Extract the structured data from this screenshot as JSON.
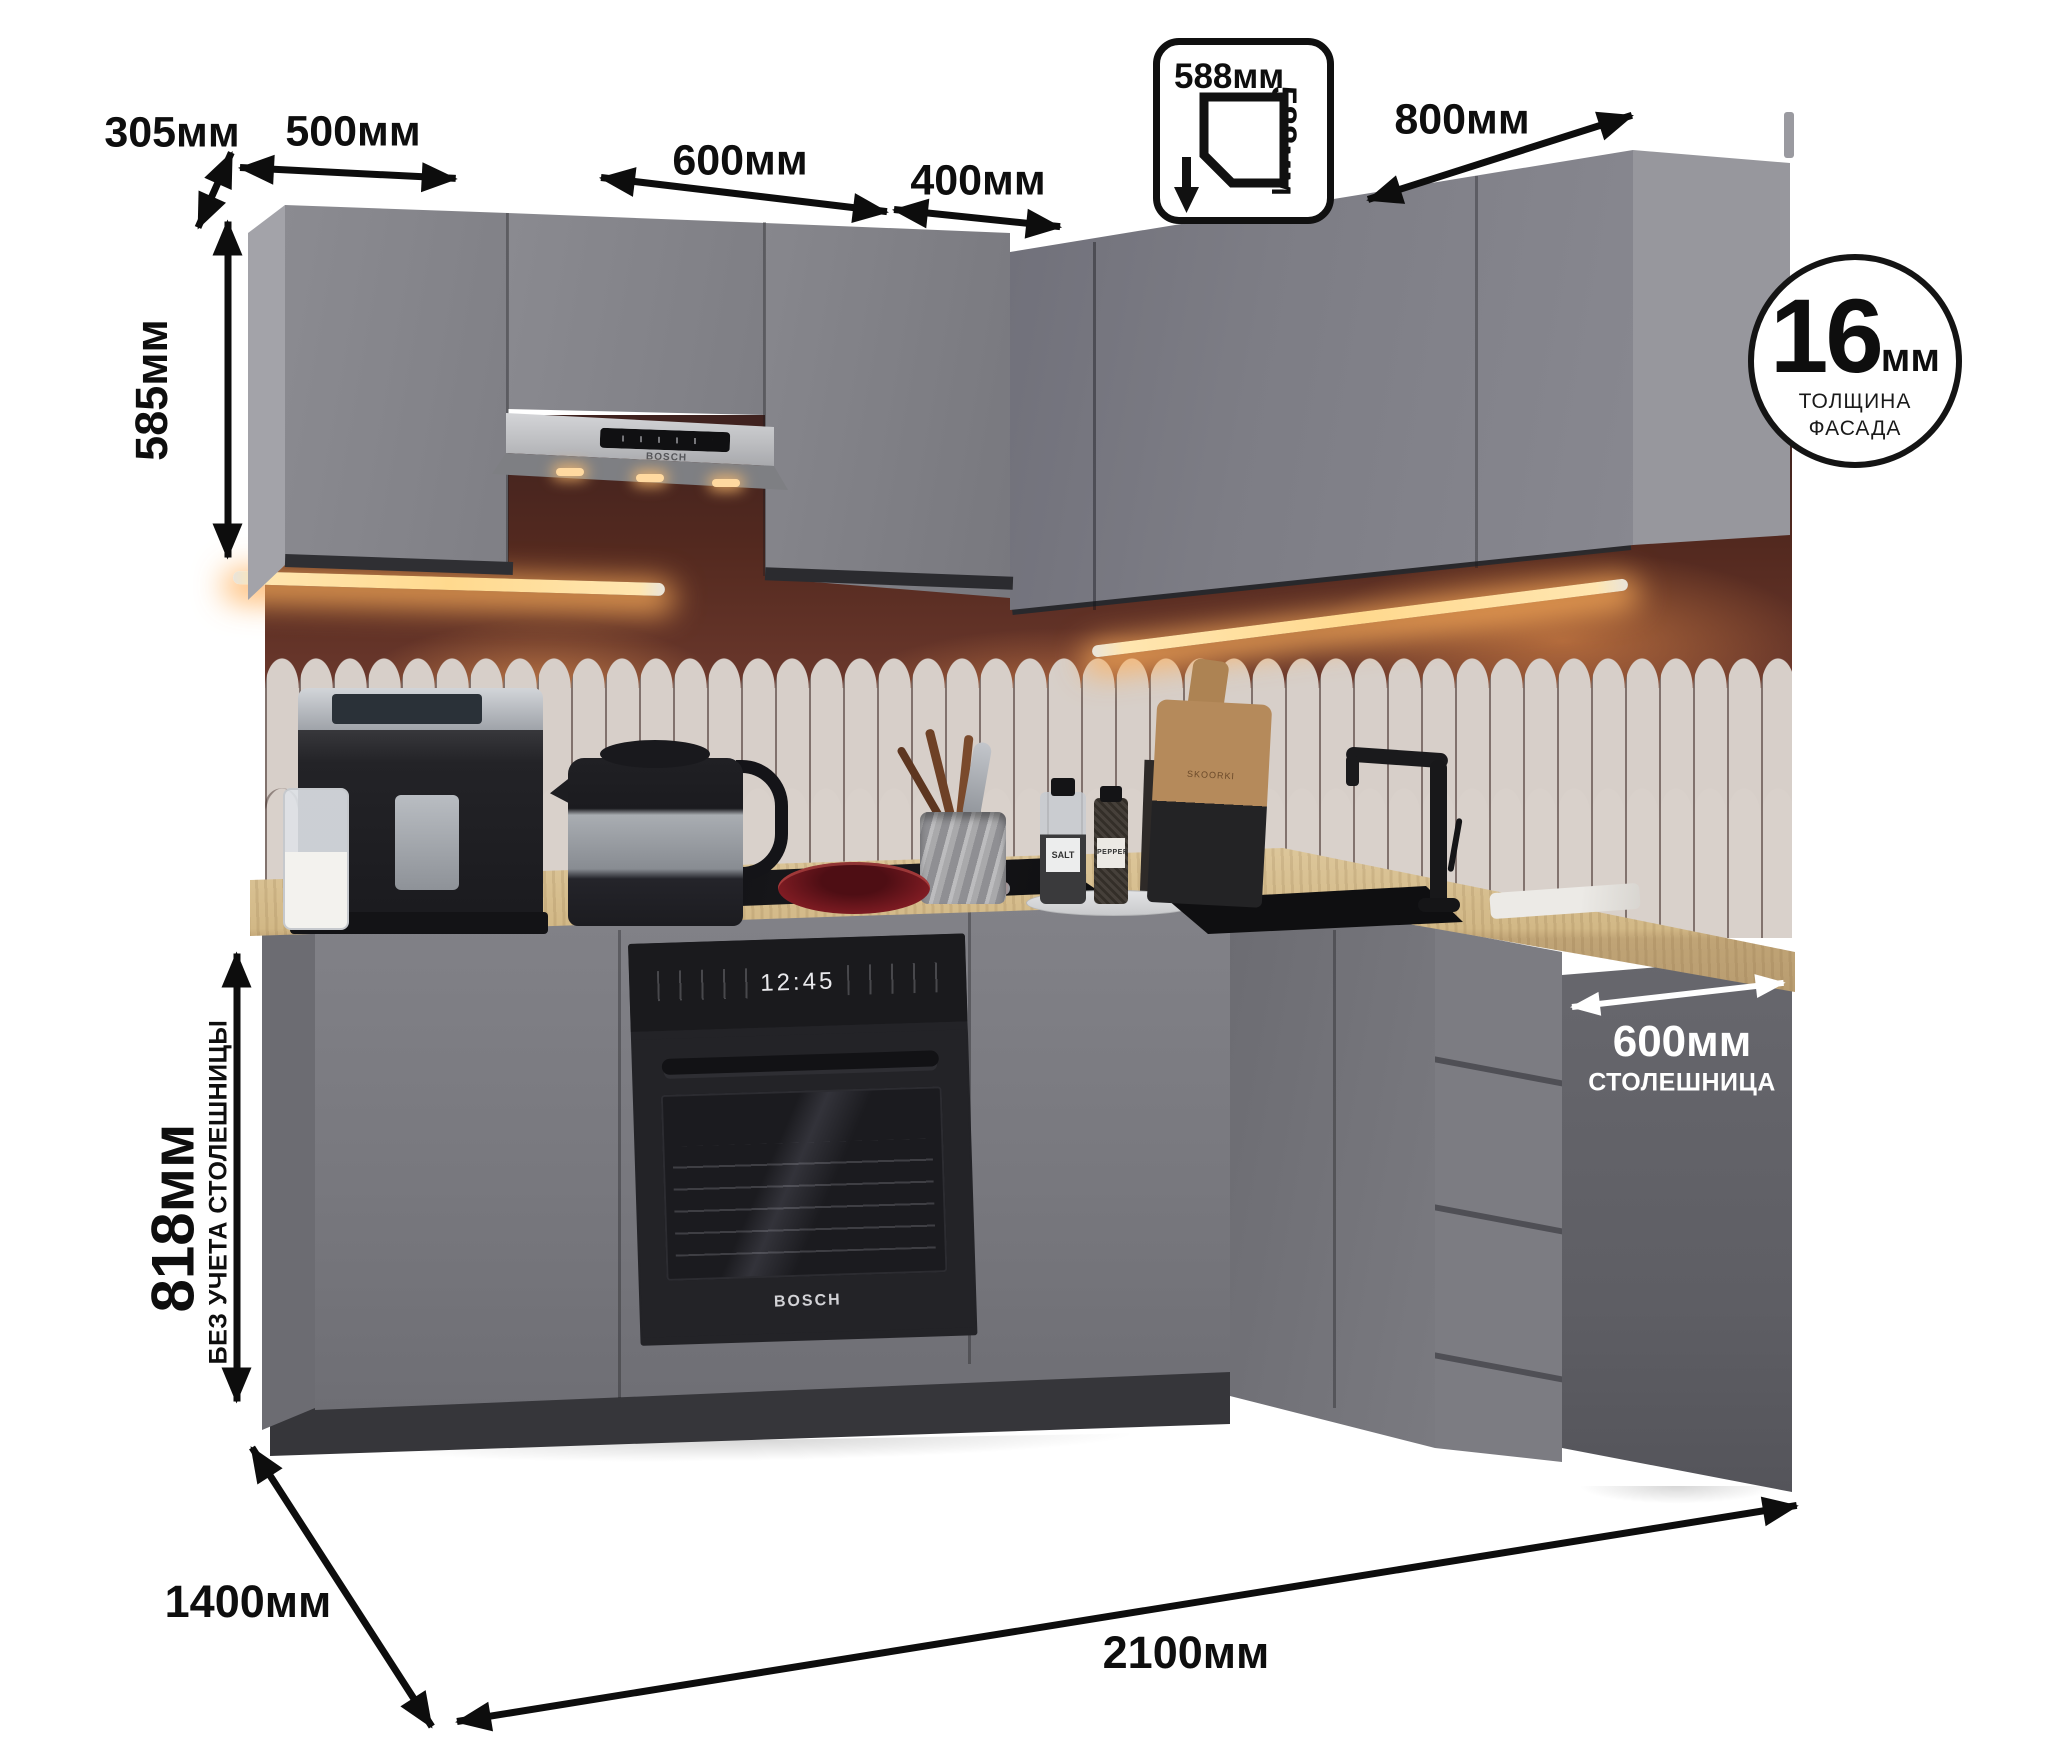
{
  "annotations": {
    "dim_305": "305мм",
    "dim_500": "500мм",
    "dim_600": "600мм",
    "dim_400": "400мм",
    "dim_800": "800мм",
    "dim_585": "585мм",
    "dim_818": "818мм",
    "dim_818_note": "БЕЗ УЧЕТА СТОЛЕШНИЦЫ",
    "dim_1400": "1400мм",
    "dim_2100": "2100мм",
    "corner_badge": {
      "top": "588мм",
      "side": "588мм"
    },
    "countertop_badge": {
      "value": "600мм",
      "caption": "СТОЛЕШНИЦА"
    },
    "facade_badge": {
      "value": "16",
      "unit": "мм",
      "line1": "ТОЛЩИНА",
      "line2": "ФАСАДА"
    }
  },
  "appliances": {
    "oven": {
      "clock": "12:45",
      "brand": "BOSCH"
    },
    "hood": {
      "brand": "BOSCH"
    }
  },
  "props": {
    "salt": "SALT",
    "pepper": "PEPPER",
    "board": "SKOORKI"
  },
  "colors": {
    "cabinet_front": "#85858b",
    "cabinet_side": "#9a9aa0",
    "base_front": "#7a7a80",
    "end_panel": "#626268",
    "wall": "#5a2f28",
    "tile": "#d7cfc9",
    "countertop": "#d3b988",
    "led_glow": "#ffd98e",
    "annotation": "#0d0d0d"
  }
}
